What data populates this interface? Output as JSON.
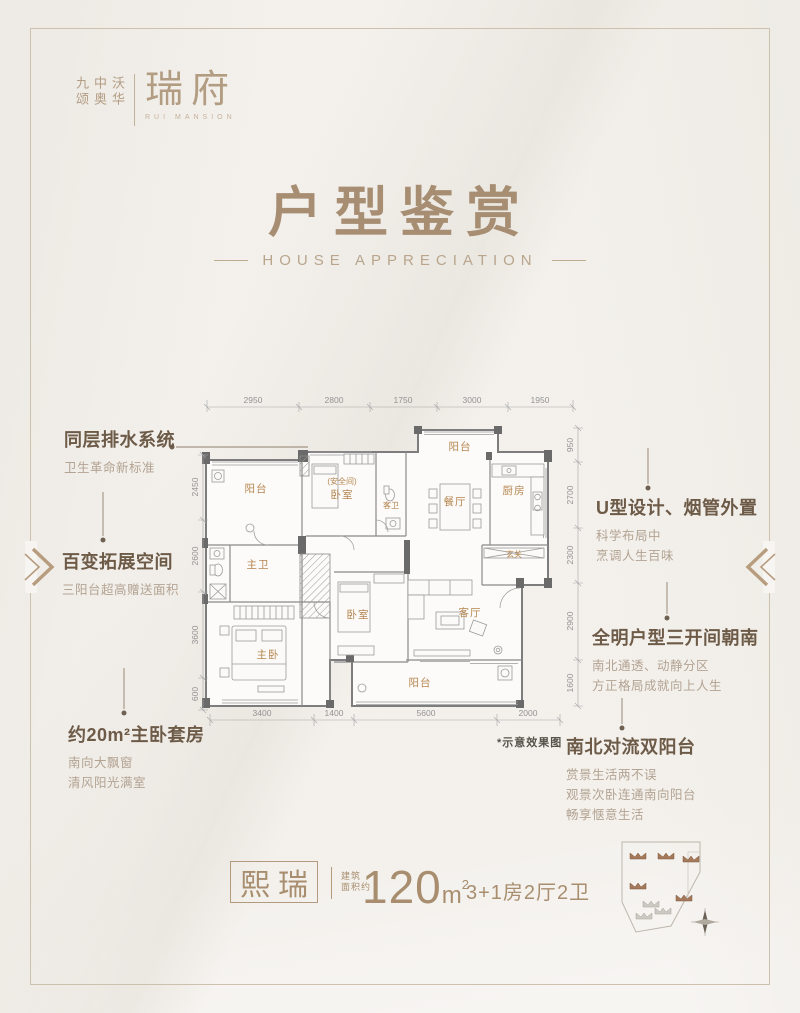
{
  "brand": {
    "company": [
      "九颂",
      "中奥",
      "沃华"
    ],
    "name": "瑞府",
    "name_en": "RUI MANSION"
  },
  "title": {
    "cn": "户型鉴赏",
    "en": "HOUSE APPRECIATION"
  },
  "callouts": {
    "left": [
      {
        "heading": "同层排水系统",
        "lines": [
          "卫生革命新标准"
        ]
      },
      {
        "heading": "百变拓展空间",
        "lines": [
          "三阳台超高赠送面积"
        ]
      },
      {
        "heading": "约20m²主卧套房",
        "lines": [
          "南向大飘窗",
          "清风阳光满室"
        ]
      }
    ],
    "right": [
      {
        "heading": "U型设计、烟管外置",
        "lines": [
          "科学布局中",
          "烹调人生百味"
        ]
      },
      {
        "heading": "全明户型三开间朝南",
        "lines": [
          "南北通透、动静分区",
          "方正格局成就向上人生"
        ]
      },
      {
        "heading": "南北对流双阳台",
        "lines": [
          "赏景生活两不误",
          "观景次卧连通南向阳台",
          "畅享惬意生活"
        ]
      }
    ]
  },
  "floorplan": {
    "note": "*示意效果图",
    "rooms": {
      "balcony_nw": "阳台",
      "master_bath": "主卫",
      "master_bedroom": "主卧",
      "safe_room": "(安全间)",
      "bedroom_safe": "卧室",
      "guest_bath": "客卫",
      "balcony_n": "阳台",
      "dining": "餐厅",
      "kitchen": "厨房",
      "foyer": "玄关",
      "bedroom2": "卧室",
      "living": "客厅",
      "balcony_s": "阳台"
    },
    "dimensions": {
      "top": [
        "2950",
        "2800",
        "1750",
        "3000",
        "1950"
      ],
      "left": [
        "2450",
        "2600",
        "3600",
        "600"
      ],
      "right": [
        "950",
        "2700",
        "2300",
        "2900",
        "1600"
      ],
      "bottom": [
        "3400",
        "1400",
        "5600",
        "2000"
      ]
    }
  },
  "footer": {
    "unit_name": "熙瑞",
    "area_prefix_line1": "建筑",
    "area_prefix_line2": "面积约",
    "area_number": "120",
    "area_unit": "m",
    "area_sup": "2",
    "spec": "3+1房2厅2卫"
  },
  "colors": {
    "accent": "#a88e6f",
    "callout_heading": "#6d5b48",
    "callout_sub": "#b3a392",
    "room_label": "#b5854f",
    "dimension": "#939393"
  }
}
